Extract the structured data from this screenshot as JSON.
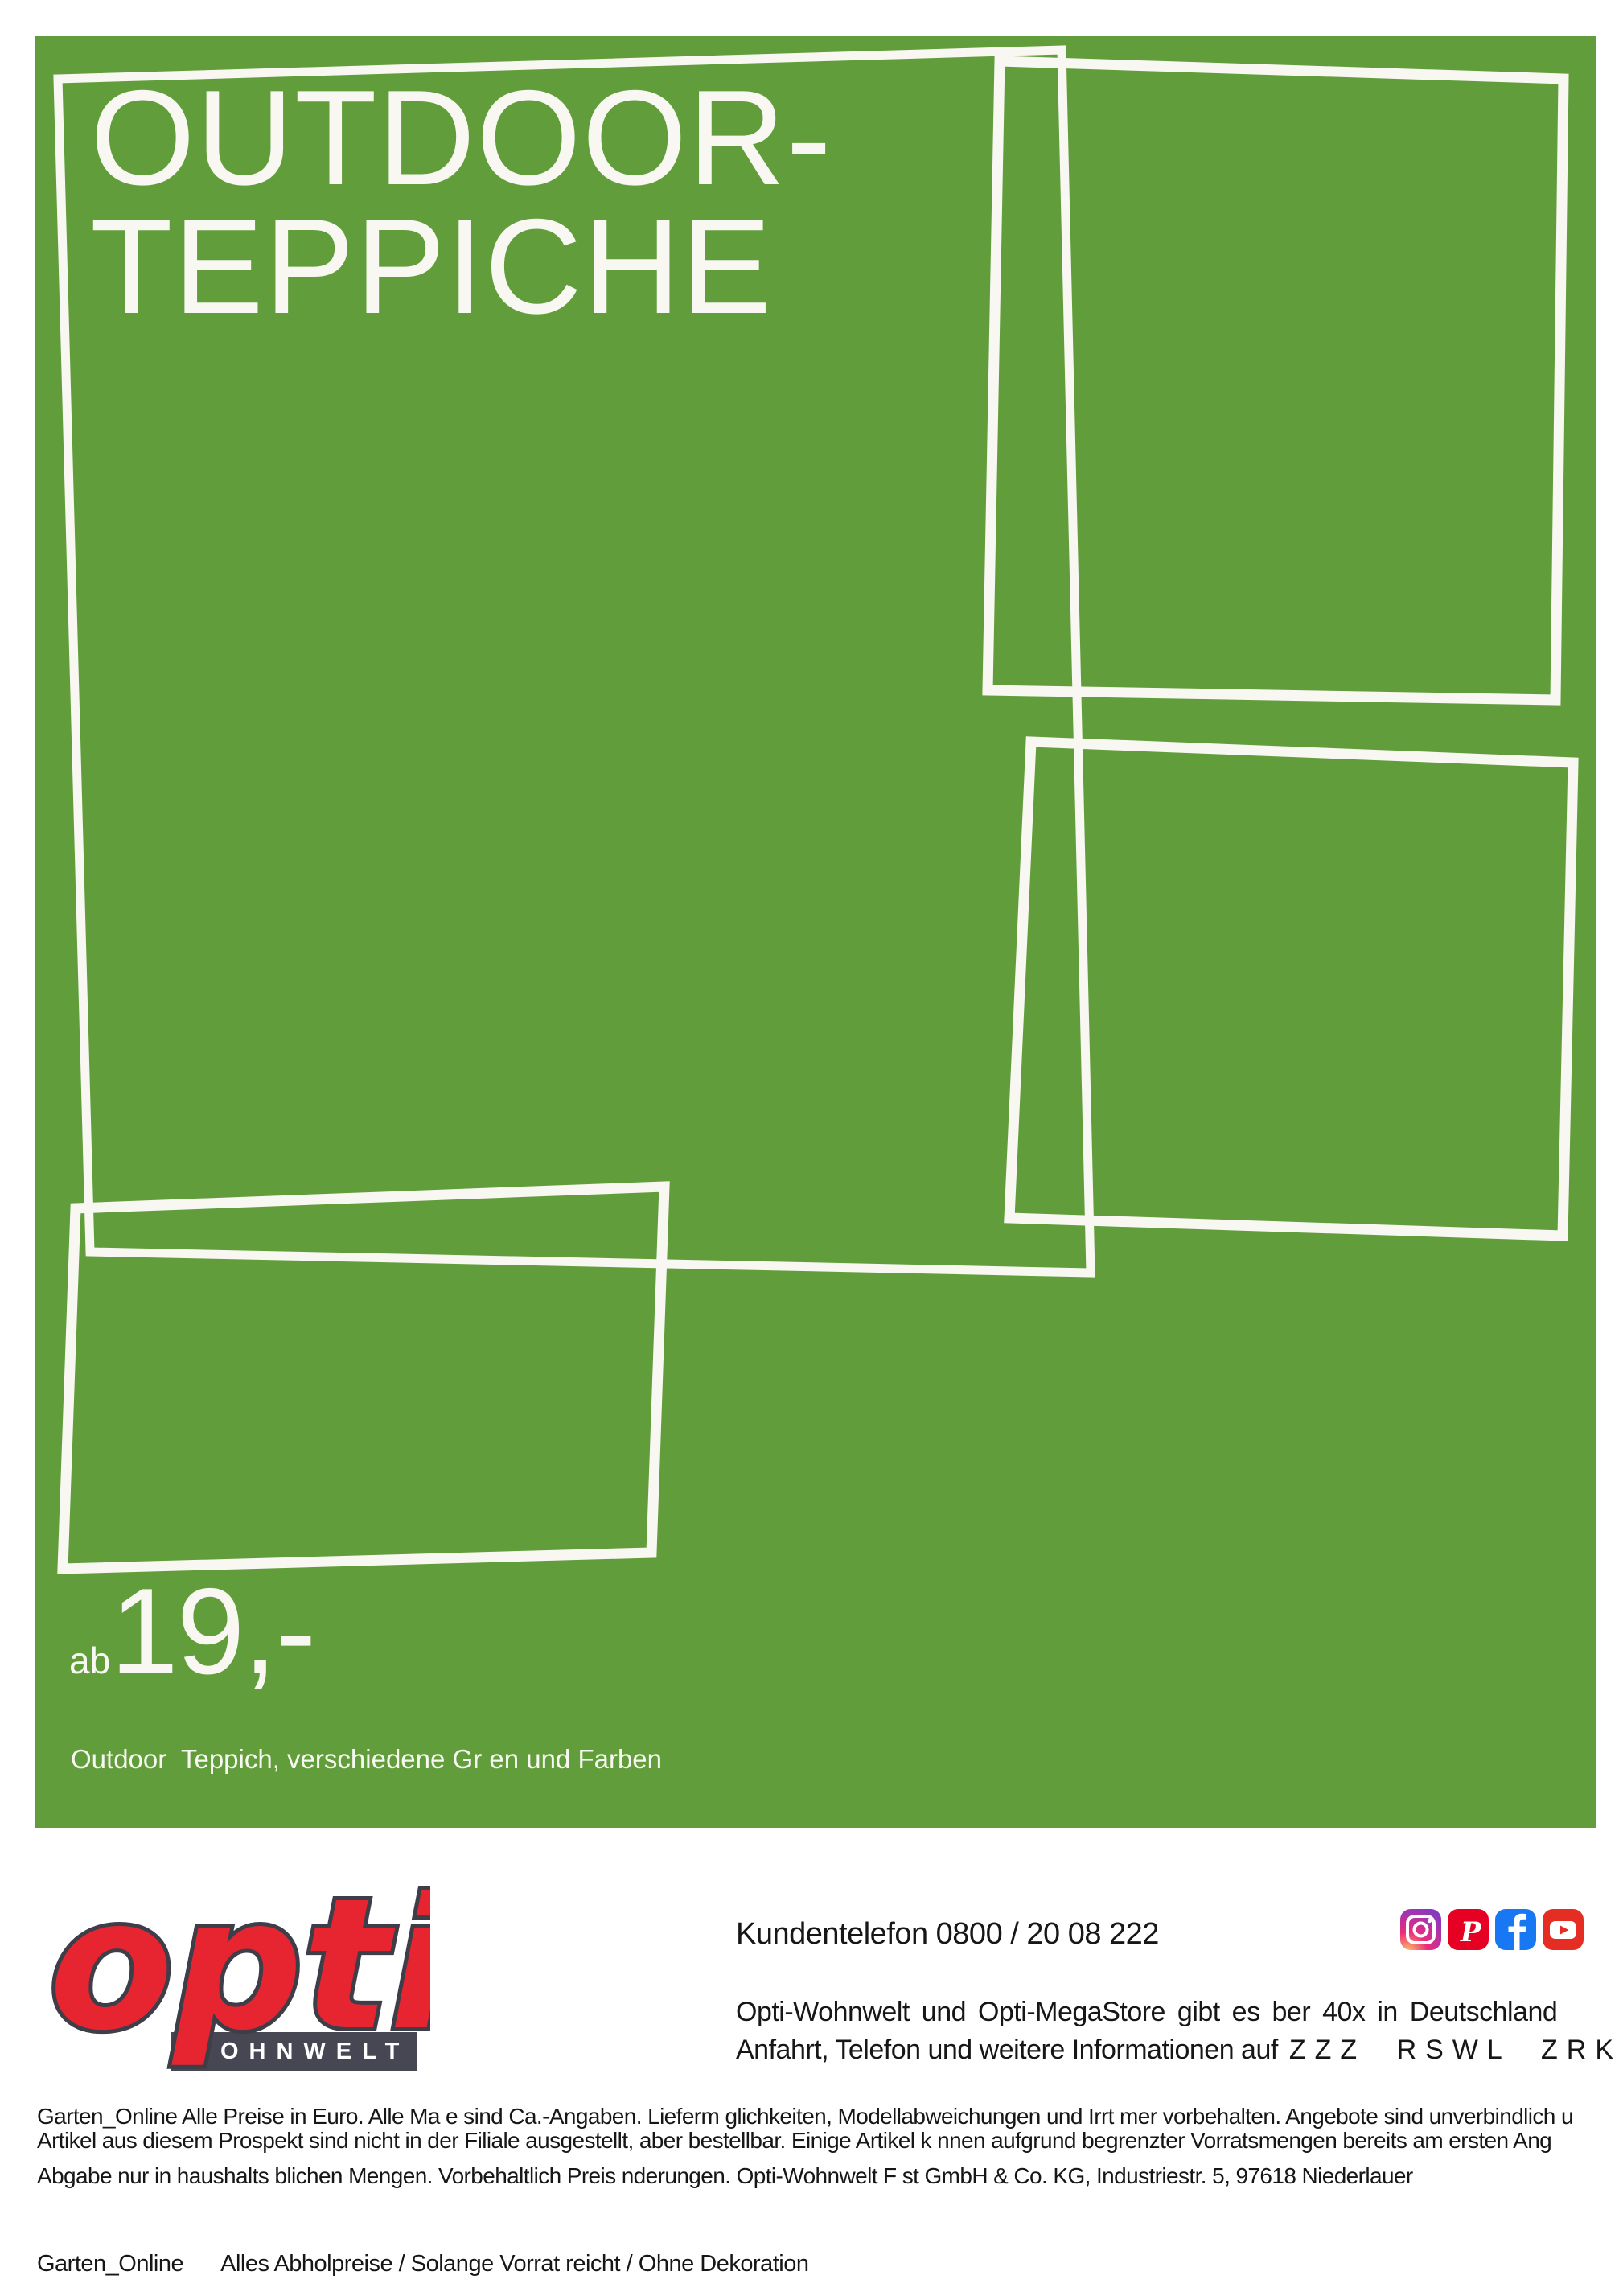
{
  "colors": {
    "green": "#619e3b",
    "frame_line": "#f8f7f2",
    "logo_red": "#e62531",
    "logo_dark": "#3e3e49",
    "banner_dark": "#474753",
    "facebook_blue": "#1877f2",
    "pinterest_red": "#e60023",
    "youtube_red": "#e62d24"
  },
  "hero": {
    "title_line1": "OUTDOOR-",
    "title_line2": "TEPPICHE",
    "price_prefix": "ab",
    "price_value": "19,-",
    "desc_line1": "Outdoor  Teppich, verschiedene Gr en und Farben",
    "desc_line2": "erh ltlich. Leicht zu reinigen, Robust und strapazierf hig.",
    "desc_line3": "12830130, 12830134, 12830133"
  },
  "footer": {
    "logo": {
      "brand": "opti",
      "sub": "WOHNWELT"
    },
    "phone": "Kundentelefon 0800 / 20 08 222",
    "info_line1": "Opti-Wohnwelt und Opti-MegaStore gibt es ber 40x in Deutschland",
    "info_line2_text": "Anfahrt, Telefon und weitere Informationen auf",
    "info_line2_code": "ZZZ RSWL ZRKQ",
    "social_icons": [
      "instagram",
      "pinterest",
      "facebook",
      "youtube"
    ],
    "legal_line1": "Garten_Online Alle Preise in Euro. Alle Ma e sind Ca.-Angaben. Lieferm glichkeiten, Modellabweichungen und Irrt mer vorbehalten. Angebote sind unverbindlich u",
    "legal_line2": "Artikel aus diesem Prospekt sind nicht in der Filiale ausgestellt, aber bestellbar. Einige Artikel k nnen aufgrund begrenzter Vorratsmengen bereits am ersten Ang",
    "legal_line3": "Abgabe nur in haushalts blichen Mengen. Vorbehaltlich Preis nderungen.   Opti-Wohnwelt F st GmbH & Co. KG, Industriestr. 5, 97618 Niederlauer",
    "bottom_label": "Garten_Online",
    "bottom_text": "Alles Abholpreise / Solange Vorrat reicht / Ohne Dekoration"
  }
}
